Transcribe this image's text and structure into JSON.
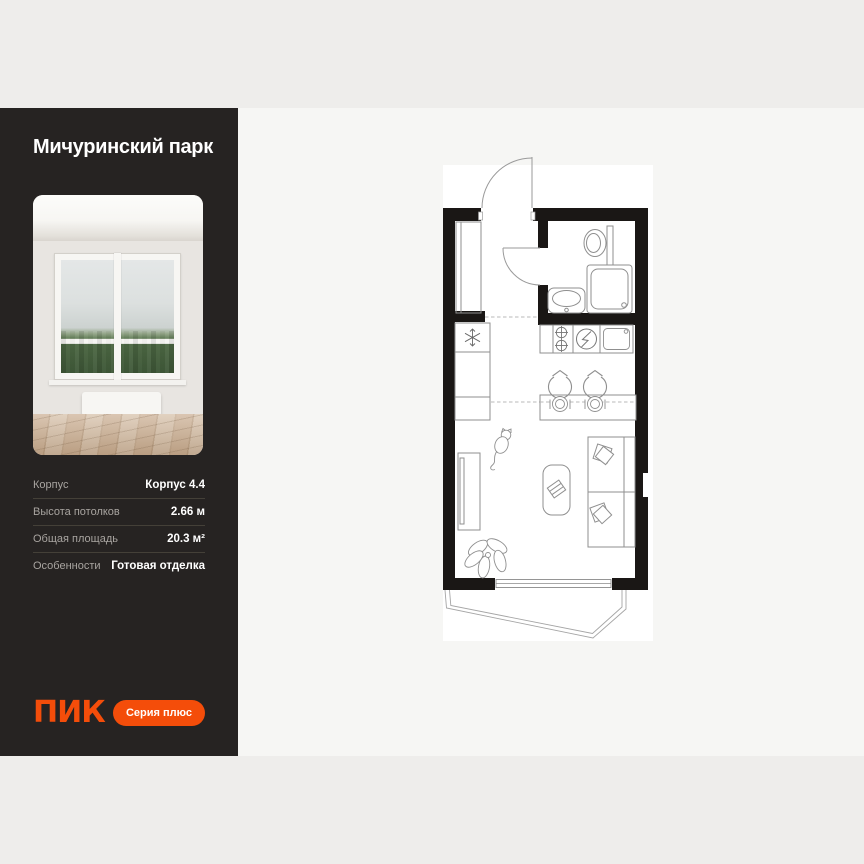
{
  "sidebar": {
    "title": "Мичуринский парк",
    "photo": {
      "description": "empty-room-with-window-view-of-trees"
    },
    "specs": [
      {
        "label": "Корпус",
        "value": "Корпус 4.4"
      },
      {
        "label": "Высота потолков",
        "value": "2.66 м"
      },
      {
        "label": "Общая площадь",
        "value": "20.3 м²"
      },
      {
        "label": "Особенности",
        "value": "Готовая отделка"
      }
    ],
    "logo": "ПИК",
    "series_button": "Серия плюс"
  },
  "floorplan": {
    "name": "studio-floor-plan",
    "icons": [
      "entrance-door",
      "wardrobe",
      "bathroom-door",
      "toilet",
      "shower",
      "washbasin",
      "fridge",
      "stove-burners",
      "electric-hob",
      "kitchen-sink",
      "kitchen-cabinets",
      "bar-counter",
      "bar-stools",
      "plates",
      "sofa",
      "pillows",
      "coffee-table",
      "cat",
      "desk",
      "plant",
      "panoramic-window",
      "balcony"
    ]
  },
  "colors": {
    "accent": "#F44D0A",
    "sidebar_bg": "#262322",
    "panel_bg": "#F6F6F4",
    "page_bg": "#EEEDEB",
    "wall": "#1A1715"
  }
}
